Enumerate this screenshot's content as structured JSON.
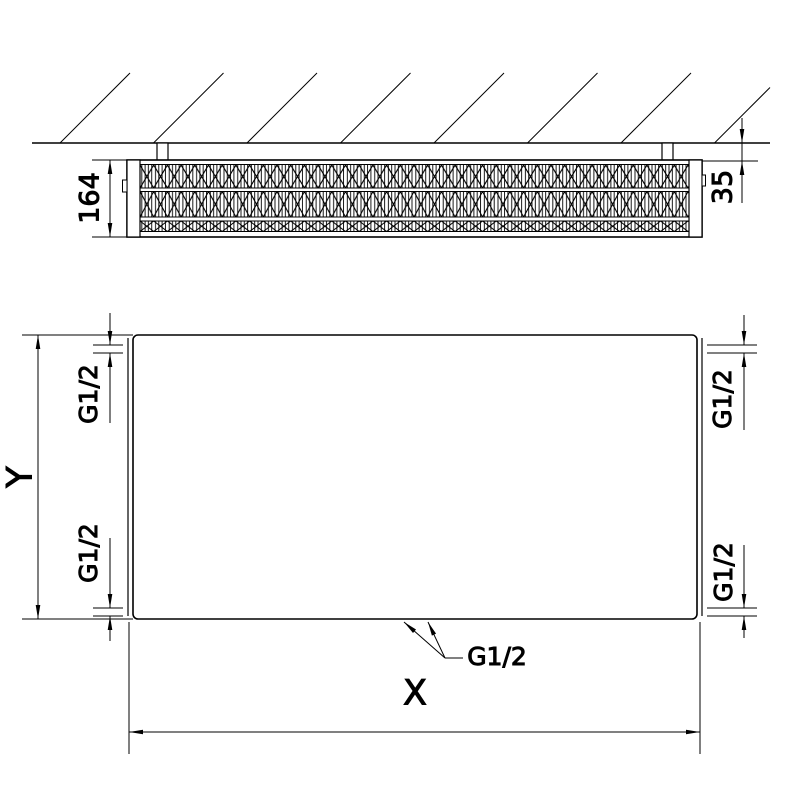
{
  "drawing": {
    "top_view": {
      "depth_label": "164",
      "wall_distance_label": "35"
    },
    "front_view": {
      "width_label": "X",
      "height_label": "Y",
      "connections": {
        "top_left": "G1/2",
        "top_right": "G1/2",
        "bottom_left": "G1/2",
        "bottom_right": "G1/2",
        "bottom_center": "G1/2"
      }
    }
  }
}
